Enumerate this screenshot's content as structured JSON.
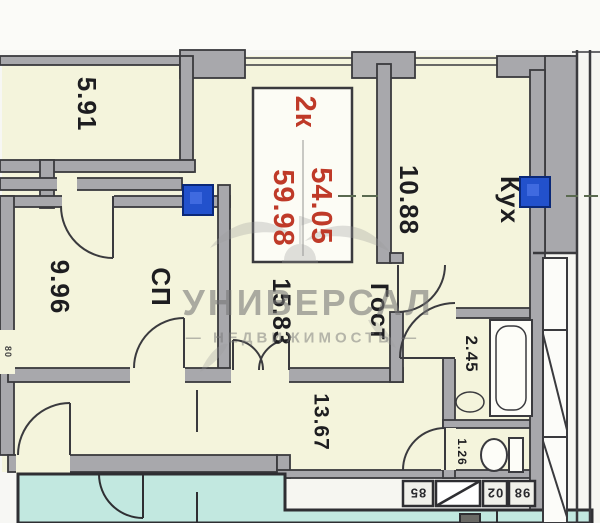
{
  "plan": {
    "apartment_type": "2к",
    "area_line1": "54.05",
    "area_line2": "59.98",
    "rooms": {
      "balcony": {
        "area": "5.91"
      },
      "kitchen": {
        "name": "Кух",
        "area": "10.88"
      },
      "bedroom": {
        "name": "СП",
        "area": "9.96"
      },
      "living": {
        "name": "Гост",
        "area": "15.83"
      },
      "bathroom": {
        "area": "2.45"
      },
      "wc": {
        "area": "1.26"
      },
      "hallway": {
        "area": "13.67"
      }
    },
    "door_width_label": "80",
    "vent_blocks": [
      "85",
      "02",
      "98"
    ],
    "colors": {
      "room_fill": "#f4f4dc",
      "neighbor_fill": "#c2e8e0",
      "wall_fill": "#a8a8ac",
      "line": "#3a3a3e",
      "accent_red": "#bf3a28",
      "marker_blue": "#2251cc"
    }
  },
  "watermark": {
    "brand": "УНИВЕРСАЛ",
    "tagline": "— НЕДВИЖИМОСТЬ —"
  }
}
